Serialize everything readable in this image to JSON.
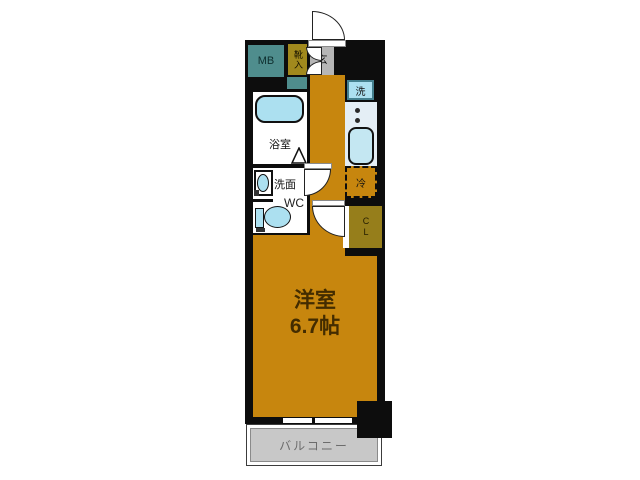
{
  "floorplan": {
    "labels": {
      "mb": "MB",
      "shoe_cabinet": "靴入",
      "entrance": "玄",
      "washer": "洗",
      "bathroom": "浴室",
      "washbasin": "洗面",
      "toilet": "WC",
      "fridge": "冷",
      "closet": "CL",
      "room_name": "洋室",
      "room_size": "6.7帖",
      "balcony": "バルコニー"
    },
    "colors": {
      "wall": "#0d0d0d",
      "room_floor": "#c7860e",
      "utility_box": "#4f8d8d",
      "storage_box": "#a1891d",
      "fixture_blue": "#ace0f0",
      "entrance_floor": "#b6b6b6",
      "balcony_floor": "#c8c8c8",
      "kitchen_counter": "#e4eef5"
    }
  }
}
